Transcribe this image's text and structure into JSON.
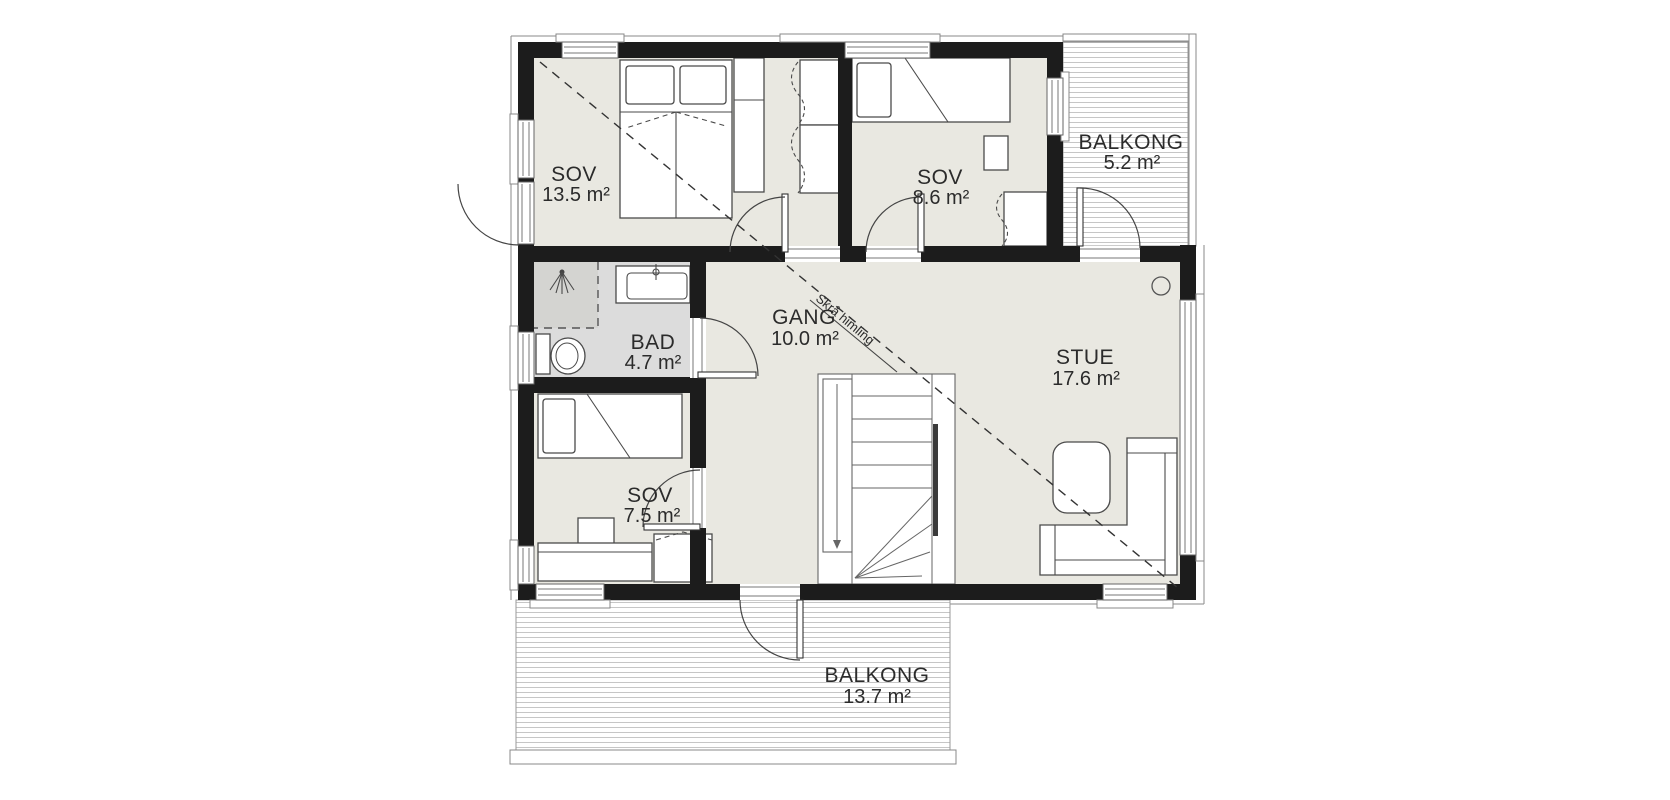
{
  "plan": {
    "rooms": [
      {
        "id": "sov-13-5",
        "name": "SOV",
        "area": "13.5 m²"
      },
      {
        "id": "sov-8-6",
        "name": "SOV",
        "area": "8.6 m²"
      },
      {
        "id": "bad",
        "name": "BAD",
        "area": "4.7 m²"
      },
      {
        "id": "gang",
        "name": "GANG",
        "area": "10.0 m²"
      },
      {
        "id": "stue",
        "name": "STUE",
        "area": "17.6 m²"
      },
      {
        "id": "sov-7-5",
        "name": "SOV",
        "area": "7.5 m²"
      },
      {
        "id": "balkong-top",
        "name": "BALKONG",
        "area": "5.2 m²"
      },
      {
        "id": "balkong-bottom",
        "name": "BALKONG",
        "area": "13.7 m²"
      }
    ],
    "annotations": {
      "sloped_ceiling": "Skrå himling"
    },
    "colors": {
      "wall": "#1c1c1c",
      "floor": "#e9e8e1",
      "bad_floor": "#dcdcdc",
      "shower_floor": "#d4d4d1",
      "deck_line": "#c6c6c6",
      "text": "#2b2b2b"
    }
  }
}
